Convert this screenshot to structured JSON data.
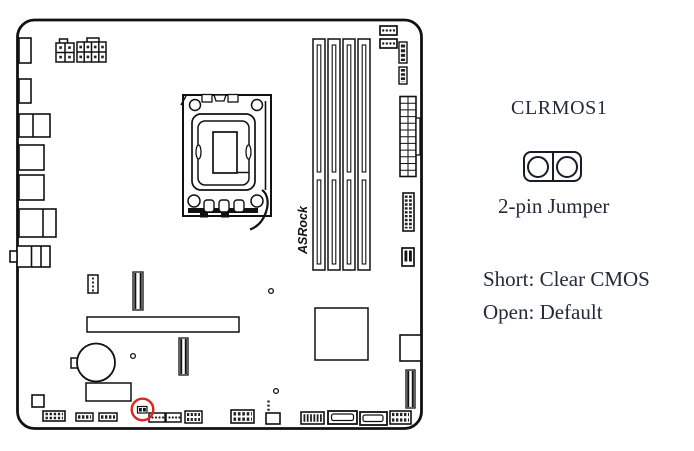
{
  "legend": {
    "jumper_name": "CLRMOS1",
    "jumper_caption": "2-pin Jumper",
    "instruction_short": "Short: Clear CMOS",
    "instruction_open": "Open: Default"
  },
  "diagram": {
    "board_logo": "ASRock",
    "highlight_color": "#dc2420",
    "line_color": "#111111",
    "ink_color": "#232a38",
    "highlighted_component": "CLRMOS1 jumper"
  }
}
